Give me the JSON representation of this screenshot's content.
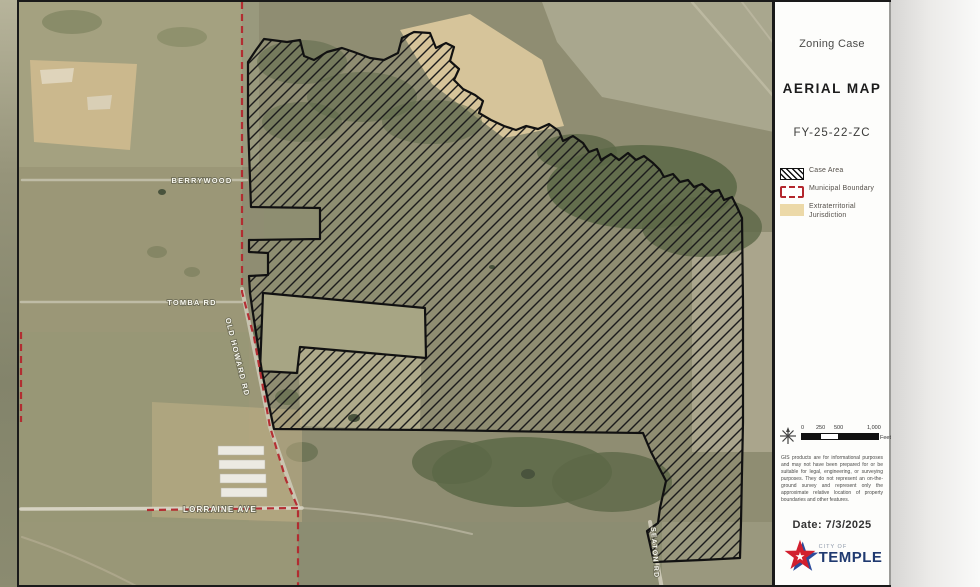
{
  "title_block": {
    "case_type": "Zoning Case",
    "map_name": "AERIAL MAP",
    "case_number": "FY-25-22-ZC"
  },
  "legend": {
    "items": [
      {
        "label": "Case Area",
        "swatch": "black-hatched-box"
      },
      {
        "label": "Municipal Boundary",
        "swatch": "red-dashed-box"
      },
      {
        "label": "Extraterritorial Jurisdiction",
        "swatch": "tan-box"
      }
    ]
  },
  "scale_bar": {
    "ticks": [
      "0",
      "250",
      "500",
      "1,000"
    ],
    "unit": "Feet"
  },
  "disclaimer": "GIS products are for informational purposes and may not have been prepared for or be suitable for legal, engineering, or surveying purposes. They do not represent an on-the-ground survey and represent only the approximate relative location of property boundaries and other features.",
  "date": {
    "text": "Date: 7/3/2025"
  },
  "logo": {
    "star_glyph": "★",
    "tagline": "CITY OF",
    "name": "TEMPLE"
  },
  "map": {
    "street_labels": [
      {
        "name": "BERRYWOOD"
      },
      {
        "name": "TOMBA RD"
      },
      {
        "name": "OLD HOWARD RD"
      },
      {
        "name": "LORRAINE AVE"
      },
      {
        "name": "SEATON RD"
      }
    ],
    "colors": {
      "aerial_base": "#8f8d72",
      "case_area_hatch": "#1c1c1c",
      "municipal_boundary": "#b3272d",
      "etj_fill": "#e8d7a5"
    }
  }
}
